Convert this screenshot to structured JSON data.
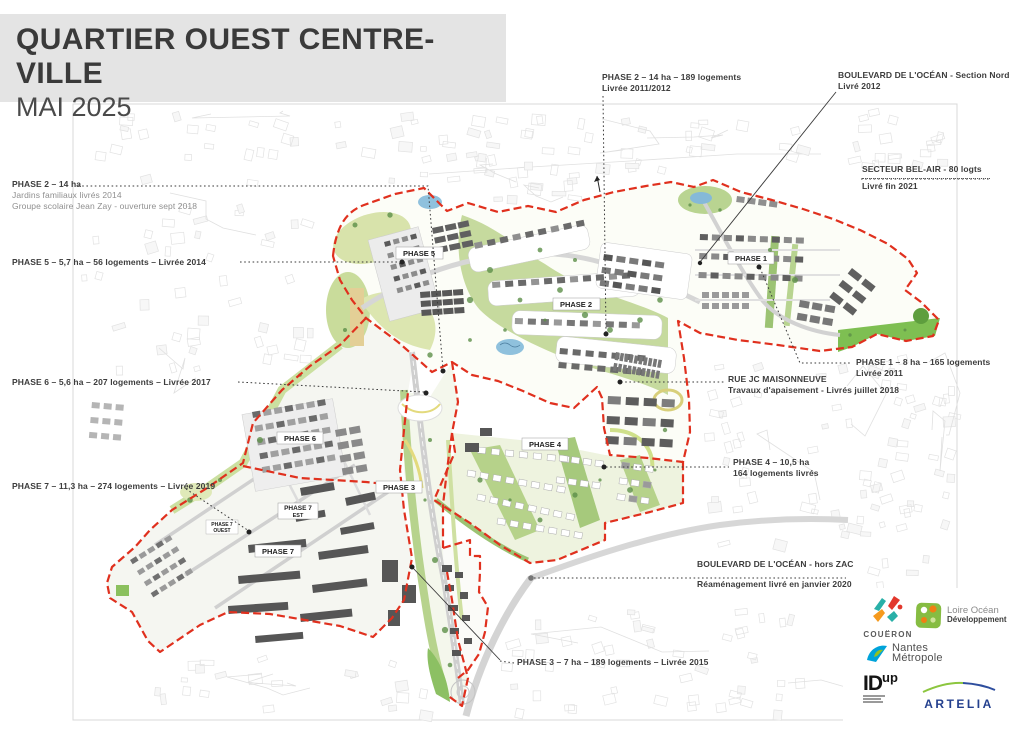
{
  "title_block": {
    "title": "QUARTIER OUEST CENTRE-VILLE",
    "subtitle": "MAI 2025"
  },
  "annotations": {
    "phase2_west": {
      "line1": "PHASE 2 – 14 ha",
      "line2": "Jardins familiaux livrés 2014",
      "line3": "Groupe scolaire Jean Zay - ouverture sept 2018"
    },
    "phase5": {
      "line1": "PHASE 5 – 5,7 ha – 56 logements –  Livrée 2014"
    },
    "phase6": {
      "line1": "PHASE 6 – 5,6 ha – 207 logements – Livrée 2017"
    },
    "phase7": {
      "line1": "PHASE 7 – 11,3 ha – 274 logements – Livrée 2019"
    },
    "phase2_north": {
      "line1": "PHASE 2 – 14 ha – 189 logements",
      "line2": "Livrée 2011/2012"
    },
    "blvd_ocean_nord": {
      "line1": "BOULEVARD DE L'OCÉAN - Section Nord",
      "line2": "Livré 2012"
    },
    "secteur_bel_air": {
      "line1": "SECTEUR BEL-AIR - 80 logts",
      "line2": "Livré fin 2021"
    },
    "phase1": {
      "line1": "PHASE 1 – 8 ha – 165 logements",
      "line2": "Livrée 2011"
    },
    "rue_jc_maisonneuve": {
      "line1": "RUE JC MAISONNEUVE",
      "line2": "Travaux d'apaisement - Livrés juillet 2018"
    },
    "phase4": {
      "line1": "PHASE 4 –  10,5 ha",
      "line2": "164 logements livrés"
    },
    "blvd_ocean_hors_zac": {
      "line1": "BOULEVARD DE L'OCÉAN - hors ZAC",
      "line2": "Réaménagement livré en janvier 2020"
    },
    "phase3": {
      "line1": "PHASE 3 – 7 ha – 189 logements –  Livrée 2015"
    }
  },
  "map_labels": {
    "phase5": "PHASE 5",
    "phase2": "PHASE 2",
    "phase1": "PHASE 1",
    "phase6": "PHASE 6",
    "phase3": "PHASE 3",
    "phase7_est_a": "PHASE 7",
    "phase7_est_b": "EST",
    "phase7": "PHASE 7",
    "phase7_ouest_a": "PHASE 7",
    "phase7_ouest_b": "OUEST",
    "phase4": "PHASE 4"
  },
  "logos": {
    "coueron": {
      "name": "COUËRON"
    },
    "loire_ocean": {
      "line1": "Loire Océan",
      "line2": "Développement"
    },
    "nantes_metropole": {
      "line1": "Nantes",
      "line2": "Métropole"
    },
    "idup": {
      "main": "ID",
      "sup": "up"
    },
    "artelia": {
      "name": "ARTELIA"
    }
  },
  "colors": {
    "boundary_red": "#e0301e",
    "green_light": "#cfe0a2",
    "green_mid": "#a8c87e",
    "green_dark": "#6f9c52",
    "water_blue": "#8fc1dd",
    "road_gray": "#d6d6d6",
    "building_gray": "#6e6e6e",
    "title_bg": "#e4e4e4",
    "text_dark": "#3c3c3c",
    "annotation_gray": "#8f8f8f"
  }
}
